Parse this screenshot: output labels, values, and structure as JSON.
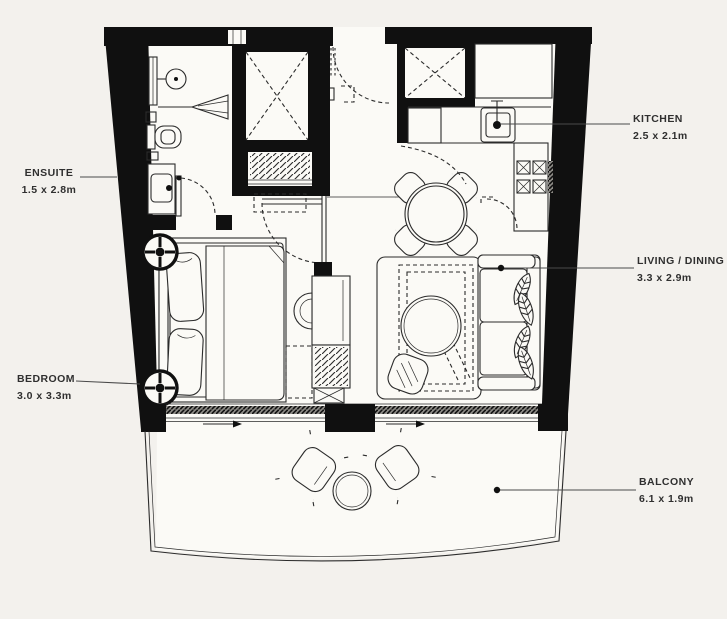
{
  "title": "Apartment floor plan",
  "colors": {
    "background": "#f3f1ed",
    "floor": "#fbfaf6",
    "wall": "#101010",
    "line": "#2b2b2b",
    "leader": "#4a4a4a",
    "label_text": "#2f2f2f"
  },
  "rooms": {
    "ensuite": {
      "label": "ENSUITE",
      "dims": "1.5 x 2.8m"
    },
    "bedroom": {
      "label": "BEDROOM",
      "dims": "3.0 x 3.3m"
    },
    "kitchen": {
      "label": "KITCHEN",
      "dims": "2.5 x 2.1m"
    },
    "living_dining": {
      "label": "LIVING / DINING",
      "dims": "3.3 x 2.9m"
    },
    "balcony": {
      "label": "BALCONY",
      "dims": "6.1 x 1.9m"
    }
  },
  "fixtures": [
    "double-bed",
    "downlights",
    "wardrobe",
    "tv-unit",
    "sofa",
    "coffee-table",
    "rug",
    "side-table",
    "dining-table",
    "dining-chairs",
    "kitchen-sink",
    "cooktop",
    "service-shaft",
    "coat-closet",
    "shower",
    "toilet",
    "vanity-basin",
    "entry-door",
    "sliding-doors",
    "balcony-chairs",
    "balcony-table",
    "railing"
  ]
}
